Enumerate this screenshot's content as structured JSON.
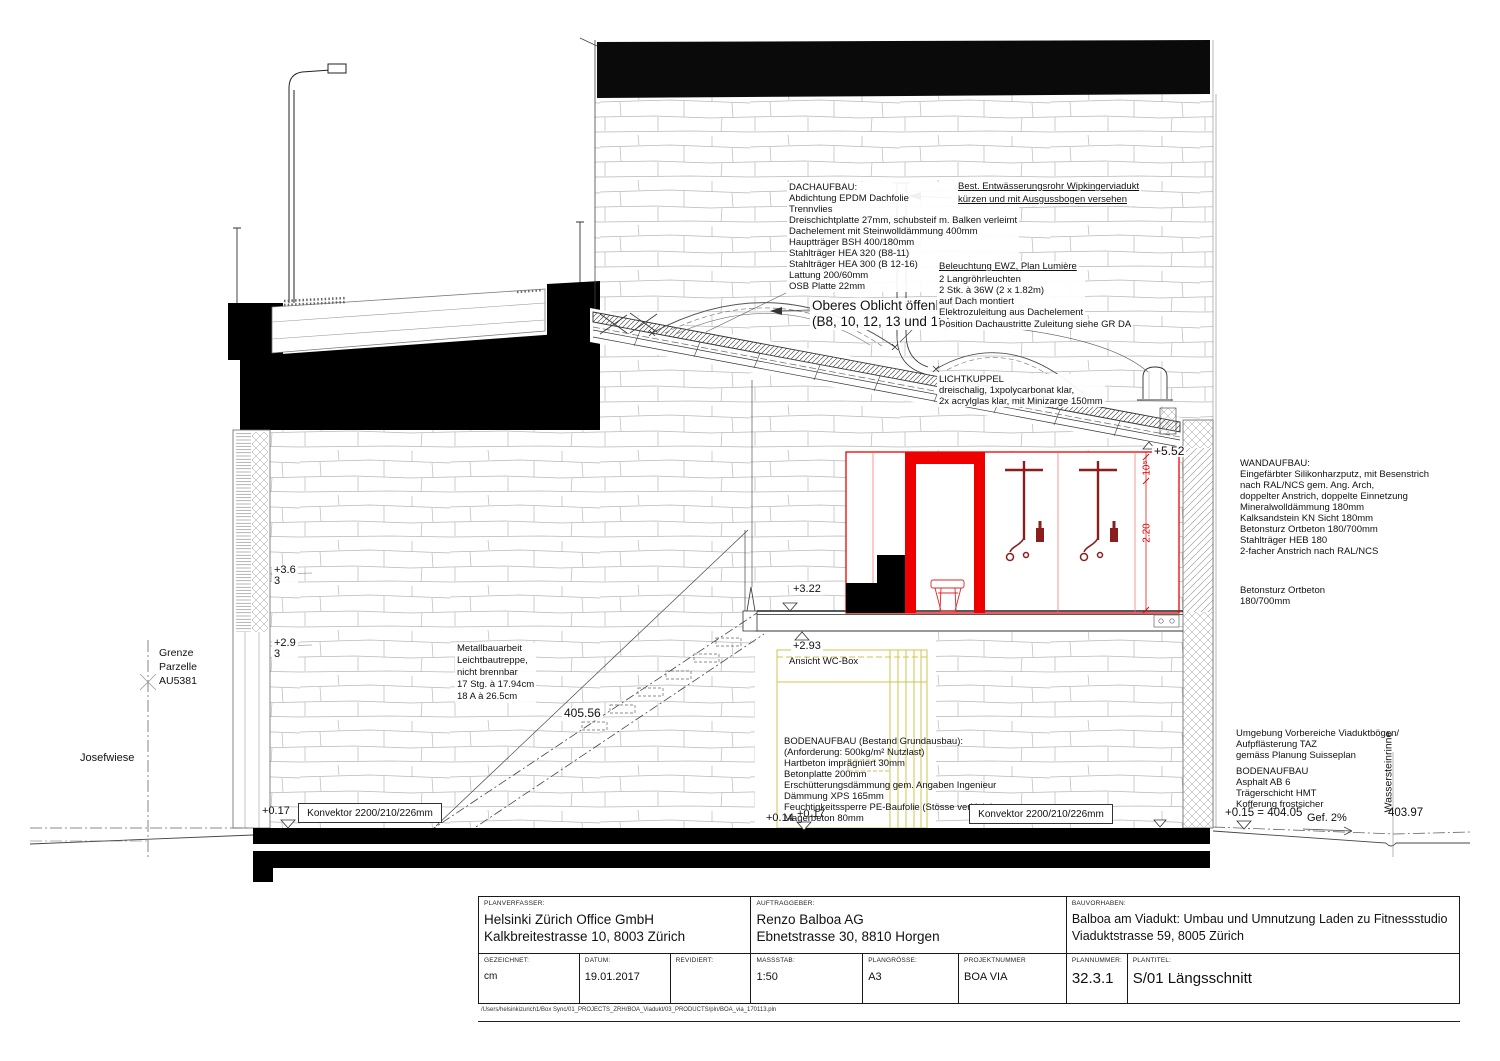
{
  "annotations": {
    "dachaufbau": "DACHAUFBAU:\nAbdichtung EPDM Dachfolie\nTrennvlies\nDreischichtplatte 27mm, schubsteif m. Balken verleimt\nDachelement mit Steinwolldämmung 400mm\nHauptträger BSH 400/180mm\nStahlträger HEA 320 (B8-11)\nStahlträger HEA 300 (B 12-16)\nLattung 200/60mm\nOSB Platte 22mm",
    "entwaesserung": "Best. Entwässerungsrohr Wipkingerviadukt\nkürzen und mit Ausgussbogen versehen",
    "oblicht": "Oberes Oblicht öffenbar\n(B8, 10, 12, 13 und 15)",
    "beleuchtung_title": "Beleuchtung EWZ, Plan Lumière",
    "beleuchtung_body": "2 Langröhrleuchten\n2 Stk. à 36W (2 x 1.82m)\nauf Dach montiert\nElektrozuleitung aus Dachelement",
    "position_dach": "Position Dachaustritte Zuleitung siehe GR DA",
    "lichtkuppel": "LICHTKUPPEL\ndreischalig, 1xpolycarbonat klar,\n2x acrylglas klar, mit Minizarge 150mm",
    "wandaufbau": "WANDAUFBAU:\nEingefärbter Silikonharzputz, mit Besenstrich\nnach RAL/NCS gem. Ang. Arch,\ndoppelter Anstrich, doppelte Einnetzung\nMineralwolldämmung 180mm\nKalksandstein KN Sicht 180mm\nBetonsturz Ortbeton 180/700mm\nStahlträger HEB 180\n2-facher Anstrich nach RAL/NCS",
    "betonsturz": "Betonsturz Ortbeton\n180/700mm",
    "metallbau": "Metallbauarbeit\nLeichtbautreppe,\nnicht brennbar\n17 Stg. à 17.94cm\n18 A à 26.5cm",
    "bodenaufbau_innen": "BODENAUFBAU (Bestand Grundausbau):\n(Anforderung: 500kg/m² Nutzlast)\nHartbeton imprägniert 30mm\nBetonplatte 200mm\nErschütterungsdämmung gem. Angaben Ingenieur\nDämmung XPS 165mm\nFeuchtigkeitssperre PE-Baufolie (Stösse verklebt)\nMagerbeton 80mm",
    "ansicht_wc": "Ansicht WC-Box",
    "umgebung": "Umgebung Vorbereiche Viaduktbögen/\nAufpflästerung TAZ\ngemäss Planung Suisseplan",
    "bodenaufbau_aussen": "BODENAUFBAU\nAsphalt AB 6\nTrägerschicht HMT\nKofferung frostsicher",
    "wassersteinrinne": "Wassersteinrinne",
    "grenze": "Grenze\nParzelle\nAU5381",
    "josefwiese": "Josefwiese",
    "konvektor_left": "Konvektor 2200/210/226mm",
    "konvektor_right": "Konvektor 2200/210/226mm",
    "gefaelle": "Gef. 2%"
  },
  "levels": {
    "v552": "+5.52",
    "v363": "+3.6\n3",
    "v293l": "+2.9\n3",
    "v322": "+3.22",
    "v293": "+2.93",
    "v017l": "+0.17",
    "v014": "+0.14",
    "v017m": "+0.17",
    "v01540405": "+0.15 = 404.05",
    "v40397": "403.97",
    "v40556": "405.56"
  },
  "dims": {
    "d105": "10⁵",
    "d220": "2.20"
  },
  "titleblock": {
    "planverfasser_label": "PLANVERFASSER:",
    "planverfasser": "Helsinki Zürich Office GmbH\nKalkbreitestrasse 10, 8003 Zürich",
    "auftraggeber_label": "AUFTRAGGEBER:",
    "auftraggeber": "Renzo Balboa AG\nEbnetstrasse 30, 8810 Horgen",
    "bauvorhaben_label": "BAUVORHABEN:",
    "bauvorhaben": "Balboa am Viadukt: Umbau und Umnutzung Laden zu Fitnessstudio\nViaduktstrasse 59, 8005 Zürich",
    "gezeichnet_label": "GEZEICHNET:",
    "gezeichnet": "cm",
    "datum_label": "DATUM:",
    "datum": "19.01.2017",
    "revidiert_label": "REVIDIERT:",
    "revidiert": "",
    "massstab_label": "MASSSTAB:",
    "massstab": "1:50",
    "plangroesse_label": "PLANGRÖSSE:",
    "plangroesse": "A3",
    "projektnummer_label": "PROJEKTNUMMER",
    "projektnummer": "BOA VIA",
    "plannummer_label": "PLANNUMMER:",
    "plannummer": "32.3.1",
    "plantitel_label": "PLANTITEL:",
    "plantitel": "S/01 Längsschnitt",
    "filepath": "/Users/helsinkizurich1/Box Sync/01_PROJECTS_ZRH/BOA_Viadukt/03_PRODUCTS/pln/BOA_via_170113.pln"
  },
  "colors": {
    "red": "#ee0000",
    "dark_red": "#8c1d1d",
    "yellow": "#d2c44e"
  }
}
